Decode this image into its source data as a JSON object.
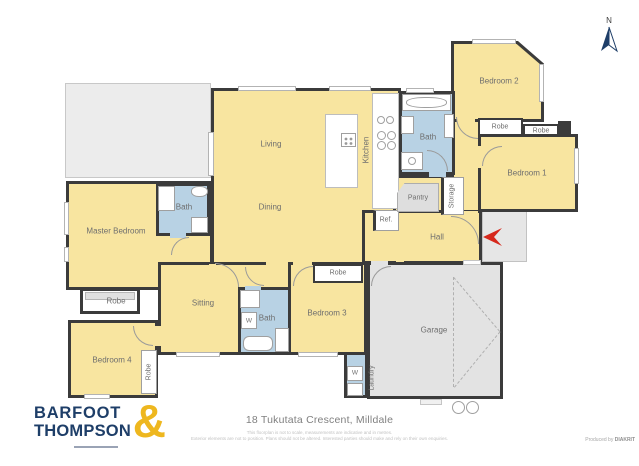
{
  "meta": {
    "address": "18 Tukutata Crescent, Milldale",
    "disclaimer_line1": "This floorplan is not to scale, measurements are indicative and in metres.",
    "disclaimer_line2": "Exterior elements are not to position. Plans should not be altered. Interested parties should make and rely on their own enquiries.",
    "produced_prefix": "Produced by",
    "producer": "DIAKRIT",
    "compass_north": "N"
  },
  "brand": {
    "line1": "BARFOOT",
    "line2": "THOMPSON",
    "ampersand": "&"
  },
  "rooms": {
    "living": "Living",
    "dining": "Dining",
    "kitchen": "Kitchen",
    "bath": "Bath",
    "pantry": "Pantry",
    "storage": "Storage",
    "ref": "Ref.",
    "hall": "Hall",
    "master": "Master Bedroom",
    "robe": "Robe",
    "sitting": "Sitting",
    "bedroom1": "Bedroom 1",
    "bedroom2": "Bedroom 2",
    "bedroom3": "Bedroom 3",
    "bedroom4": "Bedroom 4",
    "garage": "Garage",
    "laundry": "Laundry",
    "washer": "W"
  },
  "colors": {
    "room_yellow": "#f8e5a0",
    "bath_blue": "#b8d2e4",
    "garage_gray": "#e3e3e3",
    "wall": "#3b3b3b",
    "brand_navy": "#1e3e68",
    "brand_gold": "#eeb71f",
    "arrow_red": "#d6281c"
  }
}
